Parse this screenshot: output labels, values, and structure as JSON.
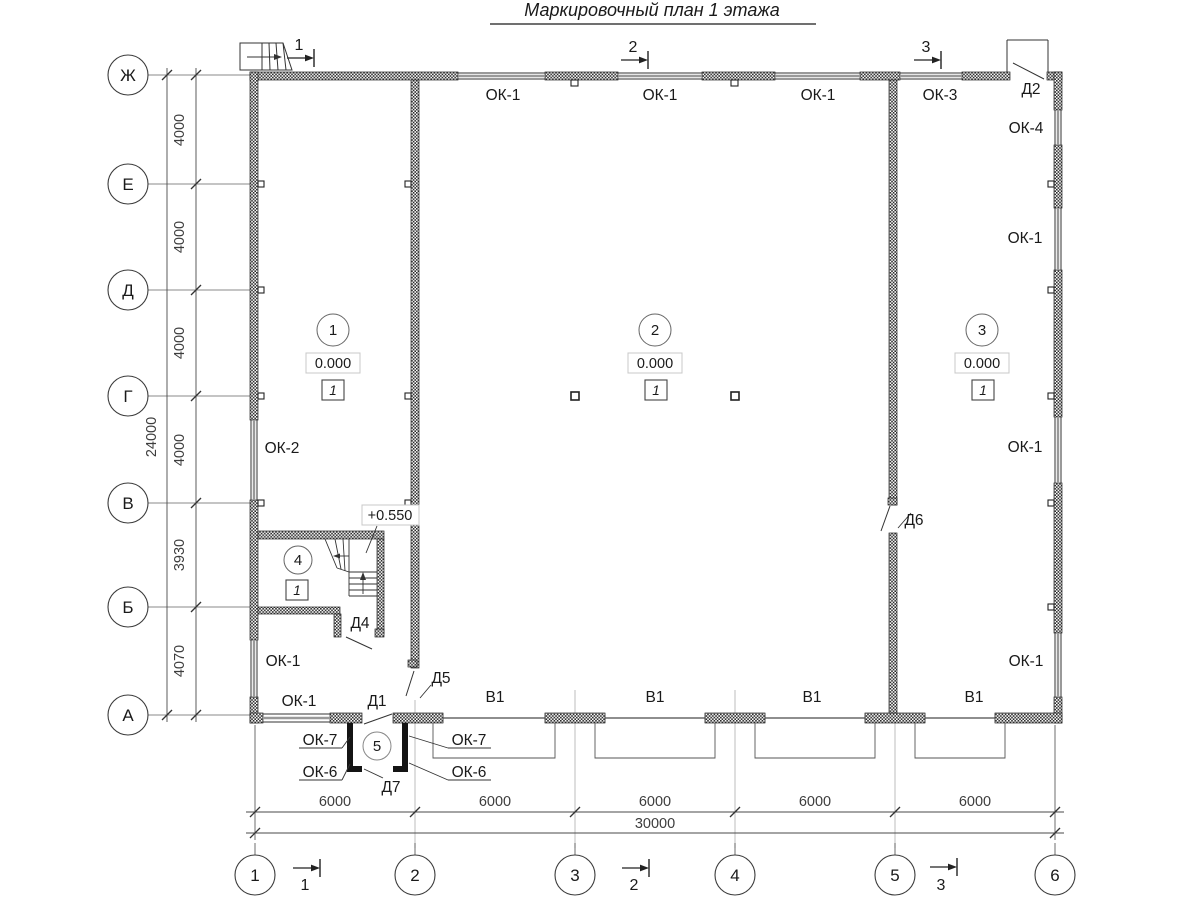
{
  "title": "Маркировочный план 1 этажа",
  "axes": {
    "rows": [
      "Ж",
      "Е",
      "Д",
      "Г",
      "В",
      "Б",
      "А"
    ],
    "cols": [
      "1",
      "2",
      "3",
      "4",
      "5",
      "6"
    ]
  },
  "dims": {
    "left": [
      "4000",
      "4000",
      "4000",
      "4000",
      "3930",
      "4070"
    ],
    "left_total": "24000",
    "bottom": [
      "6000",
      "6000",
      "6000",
      "6000",
      "6000"
    ],
    "bottom_total": "30000"
  },
  "sections": [
    "1",
    "2",
    "3"
  ],
  "rooms": {
    "r1": {
      "num": "1",
      "elev": "0.000",
      "fin": "1"
    },
    "r2": {
      "num": "2",
      "elev": "0.000",
      "fin": "1"
    },
    "r3": {
      "num": "3",
      "elev": "0.000",
      "fin": "1"
    },
    "r4": {
      "num": "4",
      "fin": "1"
    },
    "r5": {
      "num": "5"
    }
  },
  "stair": {
    "elev": "+0.550"
  },
  "windows": {
    "ok1": "ОК-1",
    "ok2": "ОК-2",
    "ok3": "ОК-3",
    "ok4": "ОК-4",
    "ok6": "ОК-6",
    "ok7": "ОК-7"
  },
  "doors": {
    "d1": "Д1",
    "d2": "Д2",
    "d4": "Д4",
    "d5": "Д5",
    "d6": "Д6",
    "d7": "Д7"
  },
  "gates": {
    "v1": "В1"
  }
}
